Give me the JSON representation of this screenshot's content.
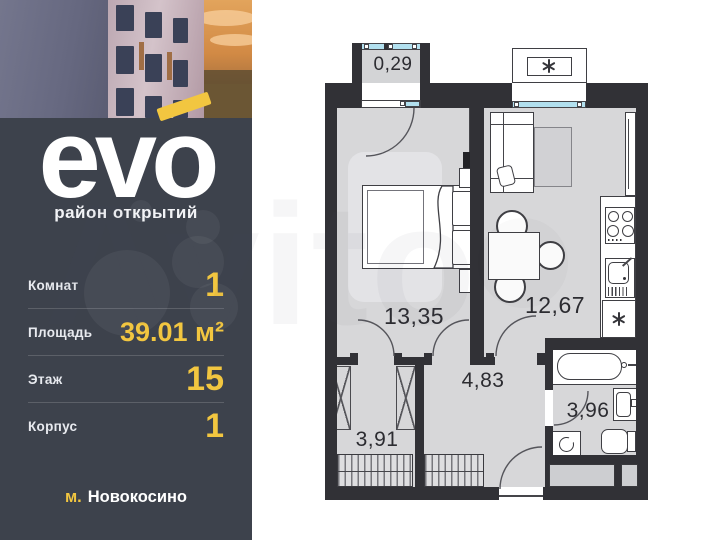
{
  "watermark": "Avito",
  "sidebar": {
    "logo": {
      "brand": "evo",
      "tagline": "район открытий"
    },
    "stats": [
      {
        "label": "Комнат",
        "value": "1"
      },
      {
        "label": "Площадь",
        "value": "39.01 м²"
      },
      {
        "label": "Этаж",
        "value": "15"
      },
      {
        "label": "Корпус",
        "value": "1"
      }
    ],
    "metro": {
      "prefix": "м.",
      "name": "Новокосино"
    },
    "accent_color": "#F2C640",
    "panel_color": "#3D424C"
  },
  "floorplan": {
    "rooms": [
      {
        "id": "balcony",
        "area": "0,29"
      },
      {
        "id": "bedroom",
        "area": "13,35"
      },
      {
        "id": "kitchen",
        "area": "12,67"
      },
      {
        "id": "wardrobe",
        "area": "3,91"
      },
      {
        "id": "hallway",
        "area": "4,83"
      },
      {
        "id": "bathroom",
        "area": "3,96"
      }
    ]
  }
}
